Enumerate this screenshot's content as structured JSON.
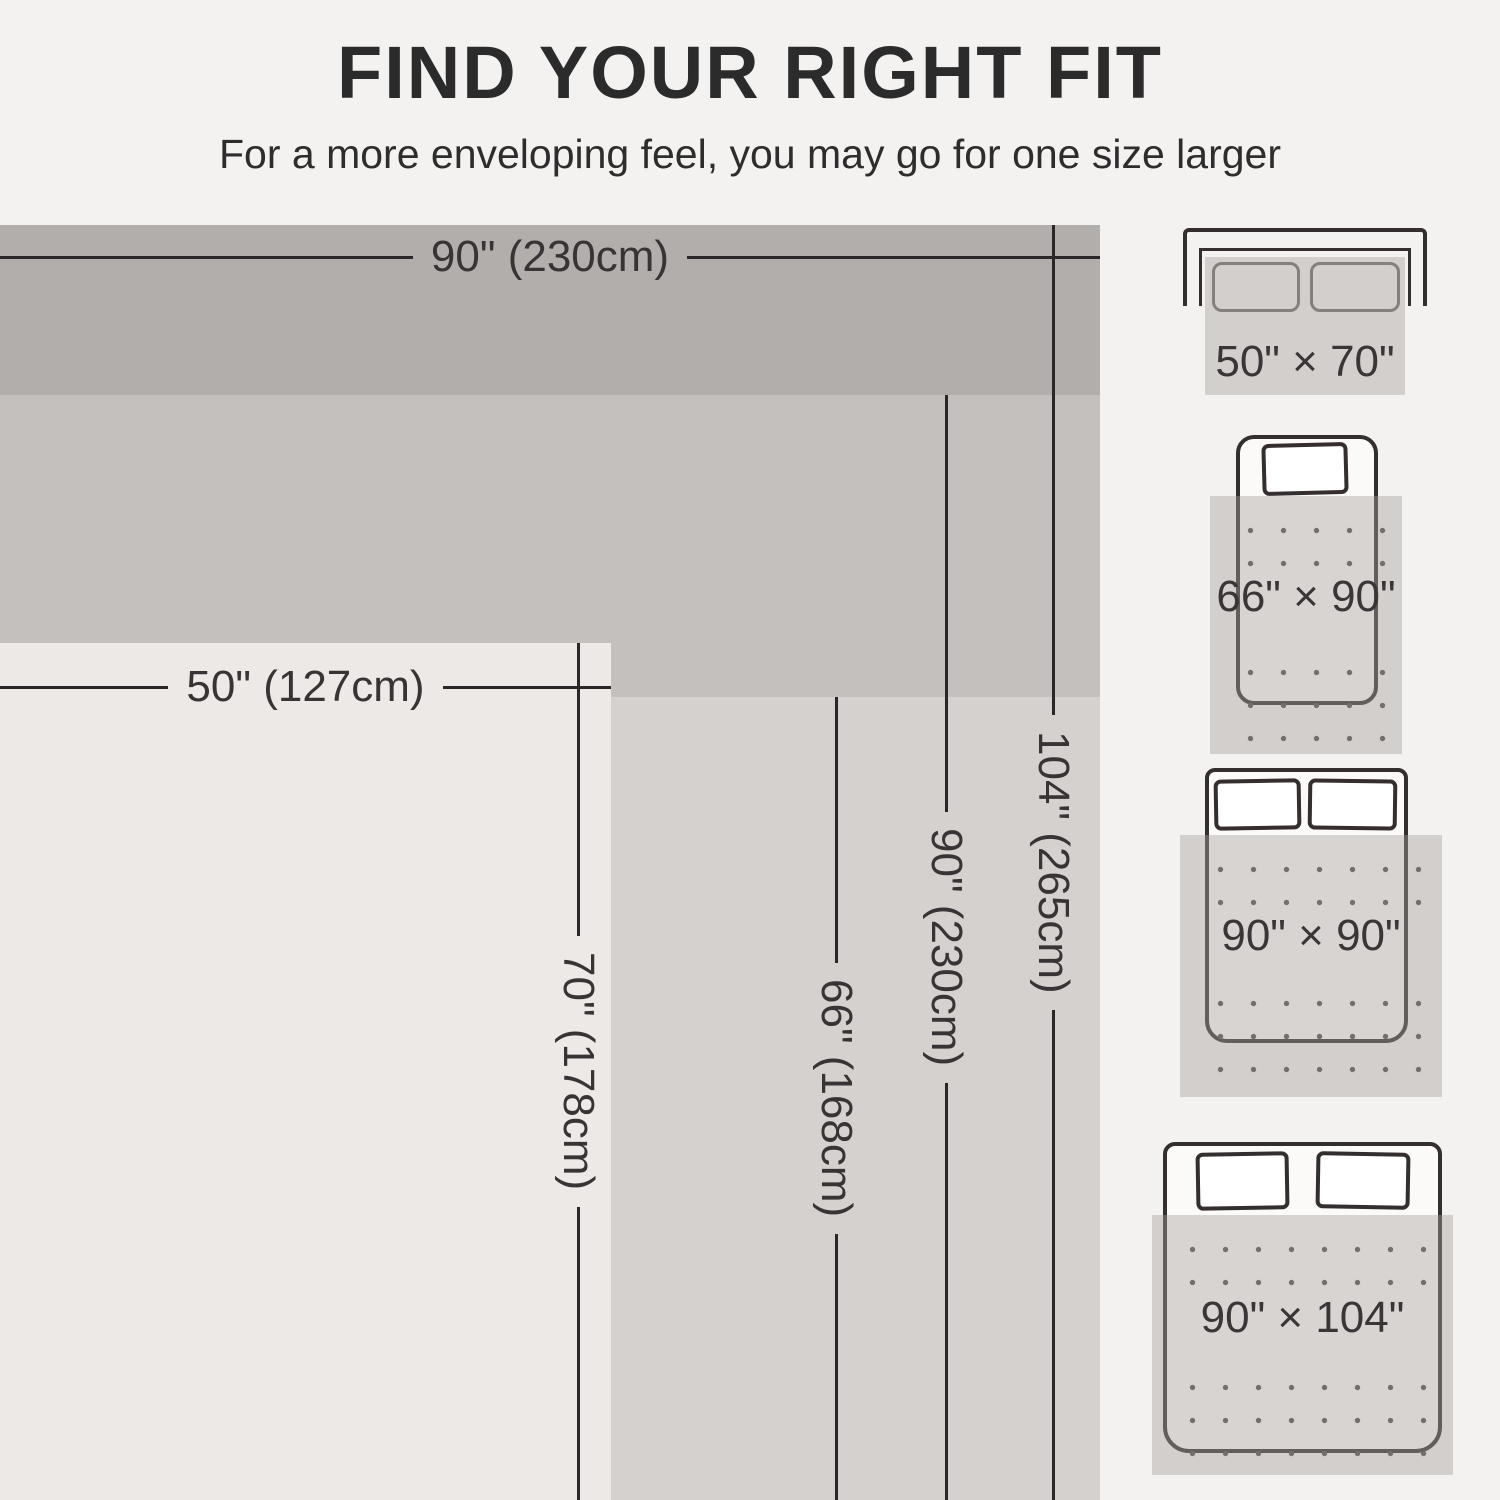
{
  "title": "FIND YOUR RIGHT FIT",
  "subtitle": "For a more enveloping feel, you may go for one size larger",
  "diagram": {
    "width_labels": [
      {
        "text": "90\" (230cm)"
      },
      {
        "text": "50\" (127cm)"
      }
    ],
    "length_labels": [
      {
        "text": "104\" (265cm)"
      },
      {
        "text": "90\" (230cm)"
      },
      {
        "text": "66\" (168cm)"
      },
      {
        "text": "70\" (178cm)"
      }
    ],
    "sizes": [
      {
        "label": "50\" × 70\"",
        "width_in": 50,
        "length_in": 70,
        "width_cm": 127,
        "length_cm": 178
      },
      {
        "label": "66\" × 90\"",
        "width_in": 66,
        "length_in": 90,
        "width_cm": 168,
        "length_cm": 230
      },
      {
        "label": "90\" × 90\"",
        "width_in": 90,
        "length_in": 90,
        "width_cm": 230,
        "length_cm": 230
      },
      {
        "label": "90\" × 104\"",
        "width_in": 90,
        "length_in": 104,
        "width_cm": 230,
        "length_cm": 265
      }
    ]
  },
  "products": [
    {
      "furniture": "sofa",
      "size_label": "50\" × 70\""
    },
    {
      "furniture": "twin-bed",
      "size_label": "66\" × 90\""
    },
    {
      "furniture": "full-bed",
      "size_label": "90\" × 90\""
    },
    {
      "furniture": "king-bed",
      "size_label": "90\" × 104\""
    }
  ],
  "colors": {
    "background": "#f4f2f0",
    "blanket_90x104": "#b1aeab",
    "blanket_90x90": "#c3c0bd",
    "blanket_66x90": "#d4d1ce",
    "blanket_50x70": "#ece9e6",
    "dimension_line": "#2b2728",
    "dimension_text": "#383435",
    "furniture_outline": "#352e2f",
    "blanket_overlay": "rgba(165,160,156,0.42)"
  }
}
